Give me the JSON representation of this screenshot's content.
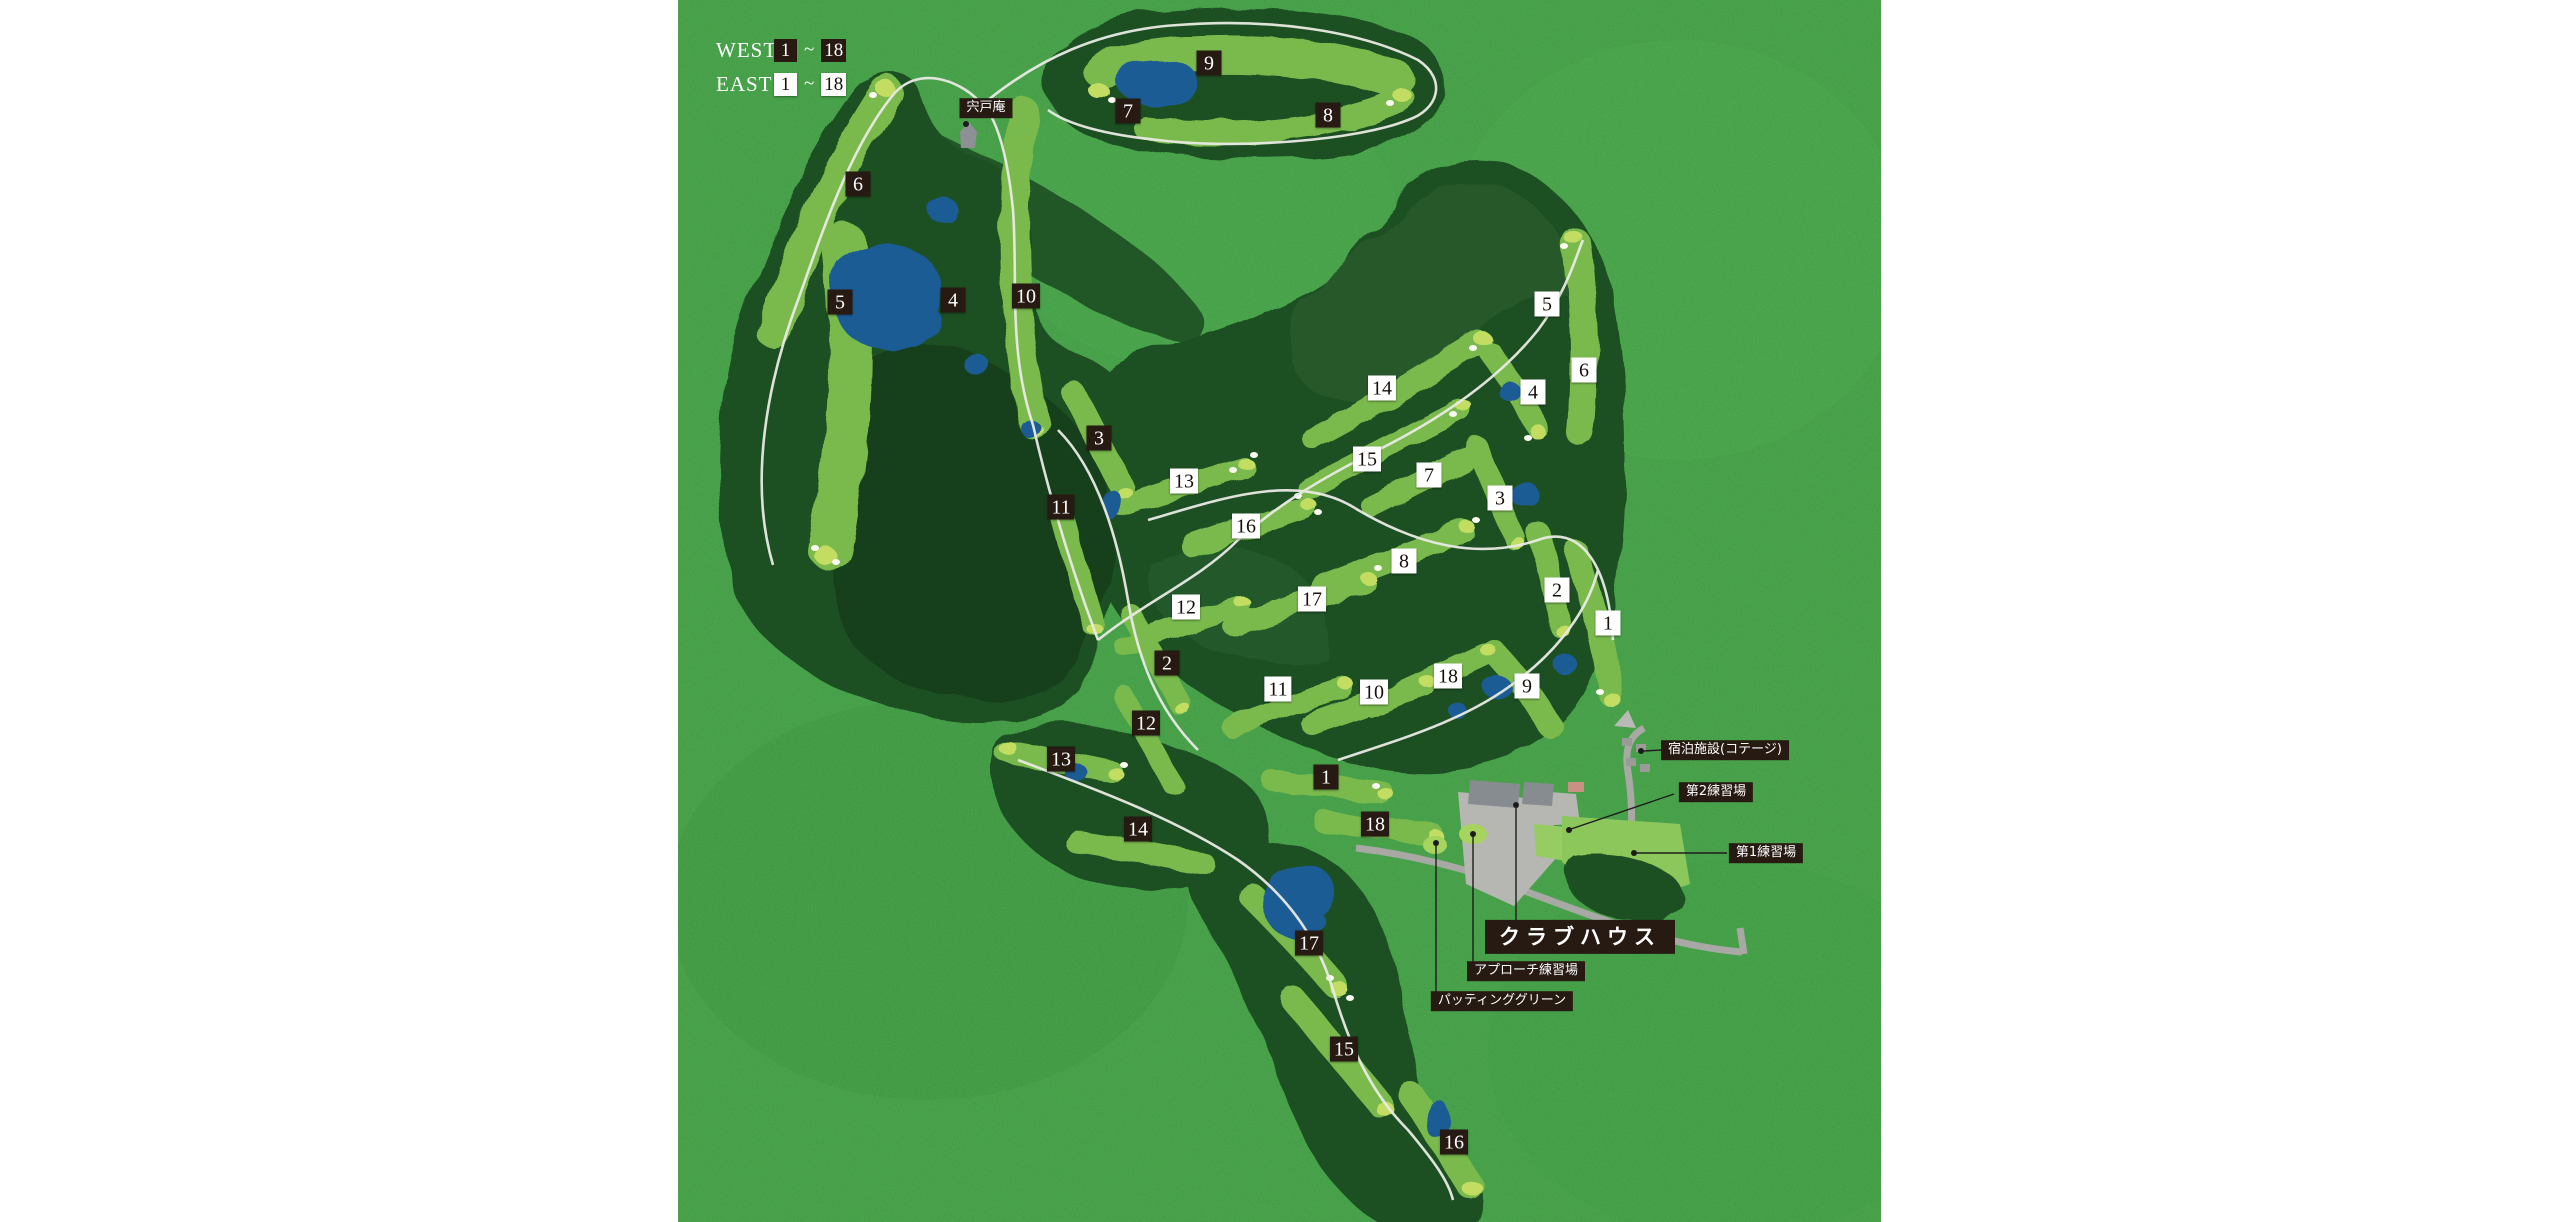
{
  "map_title": "ゴルフコースマップ",
  "legend": {
    "rows": [
      {
        "id": "west",
        "course": "WEST",
        "first_hole": "1",
        "separator": "~",
        "last_hole": "18",
        "box_style": "dark"
      },
      {
        "id": "east",
        "course": "EAST",
        "first_hole": "1",
        "separator": "~",
        "last_hole": "18",
        "box_style": "light"
      }
    ]
  },
  "markers": [
    {
      "course": "west",
      "label": "1",
      "x": 1326,
      "y": 777
    },
    {
      "course": "west",
      "label": "2",
      "x": 1167,
      "y": 663
    },
    {
      "course": "west",
      "label": "3",
      "x": 1099,
      "y": 438
    },
    {
      "course": "west",
      "label": "4",
      "x": 953,
      "y": 300
    },
    {
      "course": "west",
      "label": "5",
      "x": 840,
      "y": 302
    },
    {
      "course": "west",
      "label": "6",
      "x": 858,
      "y": 184
    },
    {
      "course": "west",
      "label": "7",
      "x": 1128,
      "y": 111
    },
    {
      "course": "west",
      "label": "8",
      "x": 1328,
      "y": 115
    },
    {
      "course": "west",
      "label": "9",
      "x": 1209,
      "y": 63
    },
    {
      "course": "west",
      "label": "10",
      "x": 1026,
      "y": 296
    },
    {
      "course": "west",
      "label": "11",
      "x": 1061,
      "y": 507
    },
    {
      "course": "west",
      "label": "12",
      "x": 1146,
      "y": 723
    },
    {
      "course": "west",
      "label": "13",
      "x": 1061,
      "y": 759
    },
    {
      "course": "west",
      "label": "14",
      "x": 1138,
      "y": 829
    },
    {
      "course": "west",
      "label": "15",
      "x": 1344,
      "y": 1049
    },
    {
      "course": "west",
      "label": "16",
      "x": 1454,
      "y": 1142
    },
    {
      "course": "west",
      "label": "17",
      "x": 1309,
      "y": 943
    },
    {
      "course": "west",
      "label": "18",
      "x": 1375,
      "y": 824
    },
    {
      "course": "east",
      "label": "1",
      "x": 1608,
      "y": 623
    },
    {
      "course": "east",
      "label": "2",
      "x": 1557,
      "y": 590
    },
    {
      "course": "east",
      "label": "3",
      "x": 1500,
      "y": 498
    },
    {
      "course": "east",
      "label": "4",
      "x": 1533,
      "y": 392
    },
    {
      "course": "east",
      "label": "5",
      "x": 1547,
      "y": 304
    },
    {
      "course": "east",
      "label": "6",
      "x": 1584,
      "y": 370
    },
    {
      "course": "east",
      "label": "7",
      "x": 1429,
      "y": 475
    },
    {
      "course": "east",
      "label": "8",
      "x": 1404,
      "y": 561
    },
    {
      "course": "east",
      "label": "9",
      "x": 1527,
      "y": 686
    },
    {
      "course": "east",
      "label": "10",
      "x": 1374,
      "y": 692
    },
    {
      "course": "east",
      "label": "11",
      "x": 1278,
      "y": 689
    },
    {
      "course": "east",
      "label": "12",
      "x": 1186,
      "y": 607
    },
    {
      "course": "east",
      "label": "13",
      "x": 1184,
      "y": 481
    },
    {
      "course": "east",
      "label": "14",
      "x": 1382,
      "y": 388
    },
    {
      "course": "east",
      "label": "15",
      "x": 1367,
      "y": 459
    },
    {
      "course": "east",
      "label": "16",
      "x": 1246,
      "y": 526
    },
    {
      "course": "east",
      "label": "17",
      "x": 1312,
      "y": 599
    },
    {
      "course": "east",
      "label": "18",
      "x": 1448,
      "y": 676
    }
  ],
  "labels": [
    {
      "id": "shishido-an",
      "text": "宍戸庵",
      "x": 986,
      "y": 108,
      "size": "small",
      "dot": {
        "x": 966,
        "y": 124
      }
    },
    {
      "id": "lodging-cottage",
      "text": "宿泊施設(コテージ)",
      "x": 1725,
      "y": 750,
      "size": "small",
      "line": [
        1662,
        750,
        1644,
        751
      ],
      "dot": {
        "x": 1641,
        "y": 751
      }
    },
    {
      "id": "practice-range-2",
      "text": "第2練習場",
      "x": 1716,
      "y": 792,
      "size": "small",
      "line": [
        1674,
        794,
        1571,
        829
      ],
      "dot": {
        "x": 1569,
        "y": 830
      }
    },
    {
      "id": "practice-range-1",
      "text": "第1練習場",
      "x": 1766,
      "y": 853,
      "size": "small",
      "line": [
        1727,
        853,
        1636,
        853
      ],
      "dot": {
        "x": 1634,
        "y": 853
      }
    },
    {
      "id": "clubhouse",
      "text": "クラブハウス",
      "x": 1580,
      "y": 937,
      "size": "large",
      "line": [
        1516,
        926,
        1516,
        807
      ],
      "dot": {
        "x": 1516,
        "y": 805
      }
    },
    {
      "id": "approach-practice",
      "text": "アプローチ練習場",
      "x": 1526,
      "y": 971,
      "size": "small",
      "line": [
        1473,
        962,
        1473,
        836
      ],
      "dot": {
        "x": 1473,
        "y": 834
      }
    },
    {
      "id": "putting-green",
      "text": "パッティンググリーン",
      "x": 1502,
      "y": 1001,
      "size": "small",
      "line": [
        1436,
        993,
        1436,
        845
      ],
      "dot": {
        "x": 1436,
        "y": 843
      }
    }
  ],
  "colors": {
    "page_background": "#ffffff",
    "field_green": "#3f9e41",
    "forest_green": "#1f5024",
    "forest_dark": "#173f1b",
    "fairway_green": "#7aba4e",
    "putting_green": "#c2dd62",
    "pond_blue": "#1e5c94",
    "cart_path_white": "#e9eae4",
    "road_gray": "#a8a8a4",
    "marker_dark": "#261a12",
    "marker_light": "#ffffff"
  }
}
